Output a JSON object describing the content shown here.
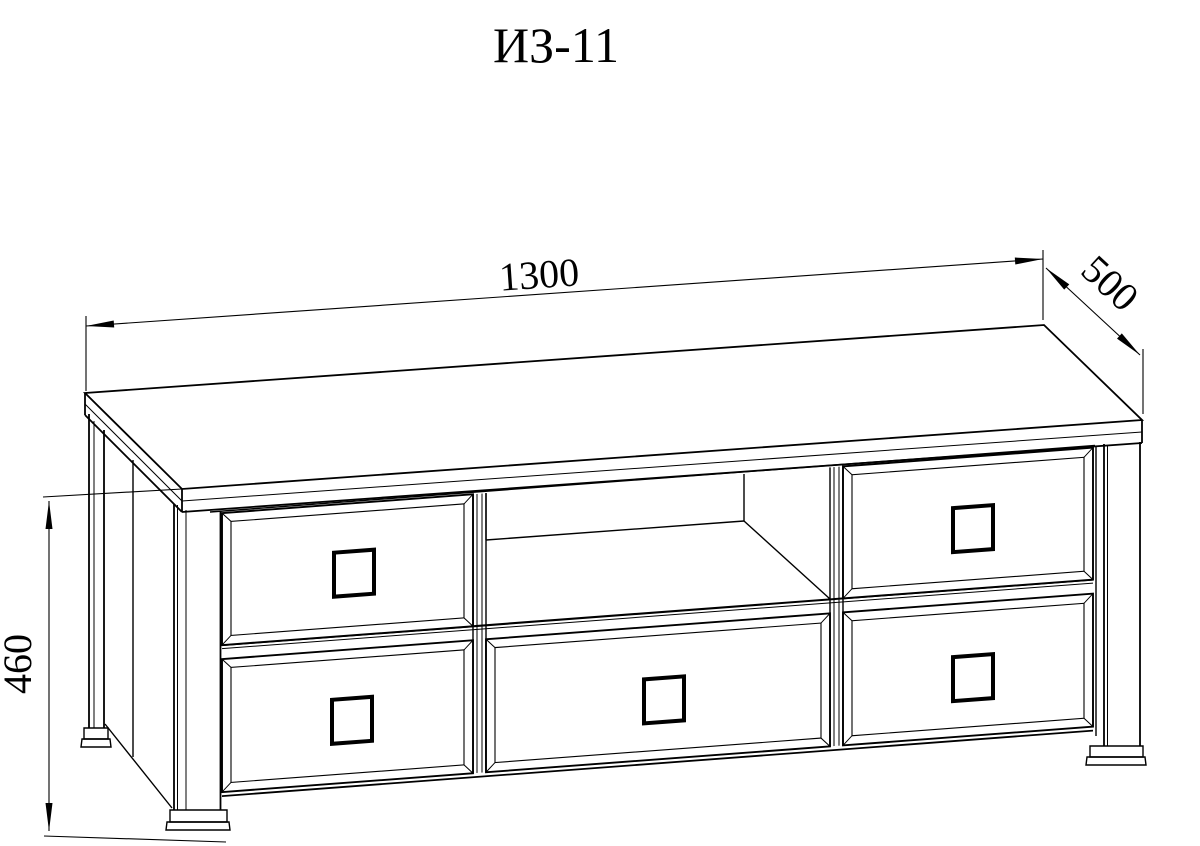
{
  "title": "ИЗ-11",
  "dimensions": {
    "width_mm": "1300",
    "depth_mm": "500",
    "height_mm": "460"
  },
  "drawing": {
    "type": "furniture-technical-drawing",
    "subject": "TV stand with five drawers, open center shelf and four legs",
    "drawer_count": 5,
    "open_shelf_count": 1,
    "leg_count": 4
  },
  "colors": {
    "line": "#000000",
    "background": "#ffffff"
  }
}
